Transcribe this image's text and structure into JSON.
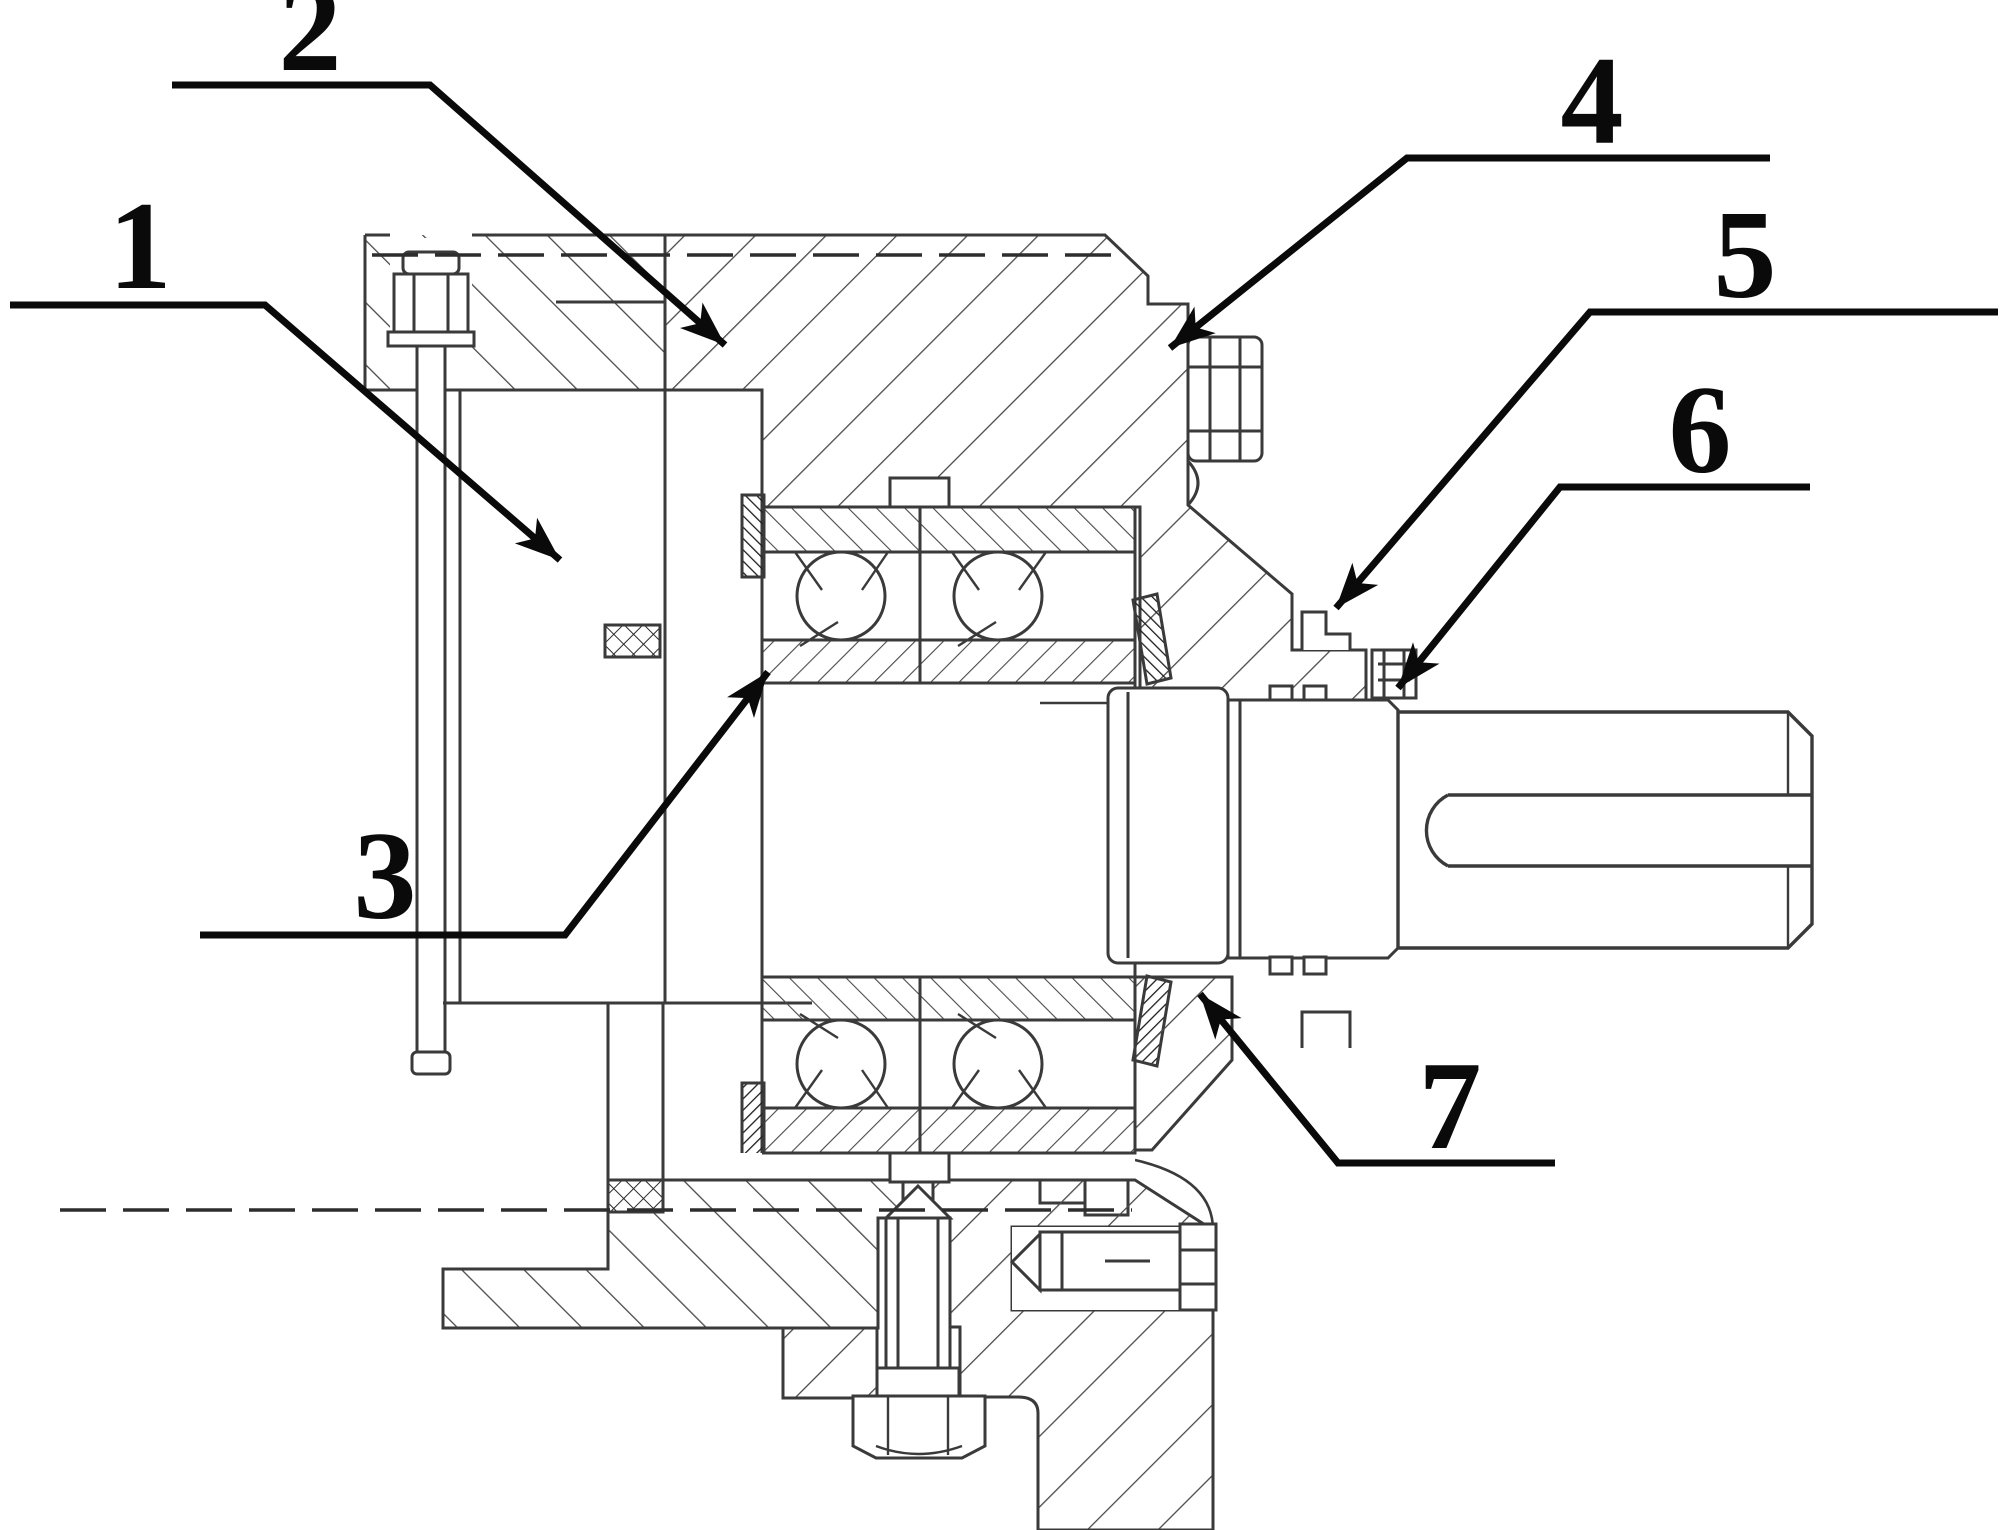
{
  "figure": {
    "kind": "patent-cross-section-diagram",
    "background_color": "#ffffff",
    "drawing_line_color": "#3a3a3a",
    "leader_line_color": "#0a0a0a",
    "callouts": [
      {
        "label": "1"
      },
      {
        "label": "2"
      },
      {
        "label": "3"
      },
      {
        "label": "4"
      },
      {
        "label": "5"
      },
      {
        "label": "6"
      },
      {
        "label": "7"
      }
    ]
  }
}
